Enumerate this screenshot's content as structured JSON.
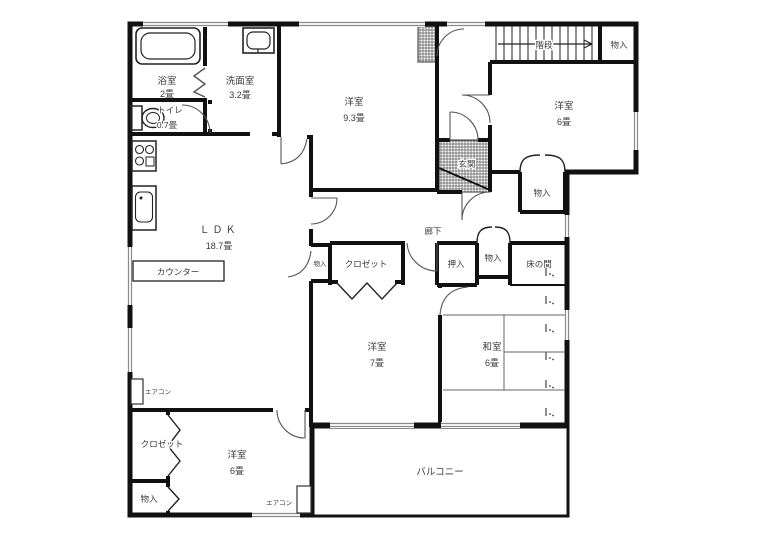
{
  "rooms": {
    "bathroom": {
      "label": "浴室",
      "area": "2畳"
    },
    "washroom": {
      "label": "洗面室",
      "area": "3.2畳"
    },
    "toilet": {
      "label": "トイレ",
      "area": "0.7畳"
    },
    "western_north": {
      "label": "洋室",
      "area": "9.3畳"
    },
    "western_ne": {
      "label": "洋室",
      "area": "6畳"
    },
    "ldk": {
      "label": "ＬＤＫ",
      "area": "18.7畳"
    },
    "western_center": {
      "label": "洋室",
      "area": "7畳"
    },
    "japanese_room": {
      "label": "和室",
      "area": "6畳"
    },
    "western_sw": {
      "label": "洋室",
      "area": "6畳"
    },
    "balcony": {
      "label": "バルコニー"
    },
    "entrance": {
      "label": "玄関"
    },
    "hallway": {
      "label": "廊下"
    },
    "stairs": {
      "label": "階段"
    }
  },
  "features": {
    "counter": "カウンター",
    "closet": "クロゼット",
    "oshiire": "押入",
    "tokonoma": "床の間",
    "storage": "物入",
    "aircon": "エアコン"
  }
}
